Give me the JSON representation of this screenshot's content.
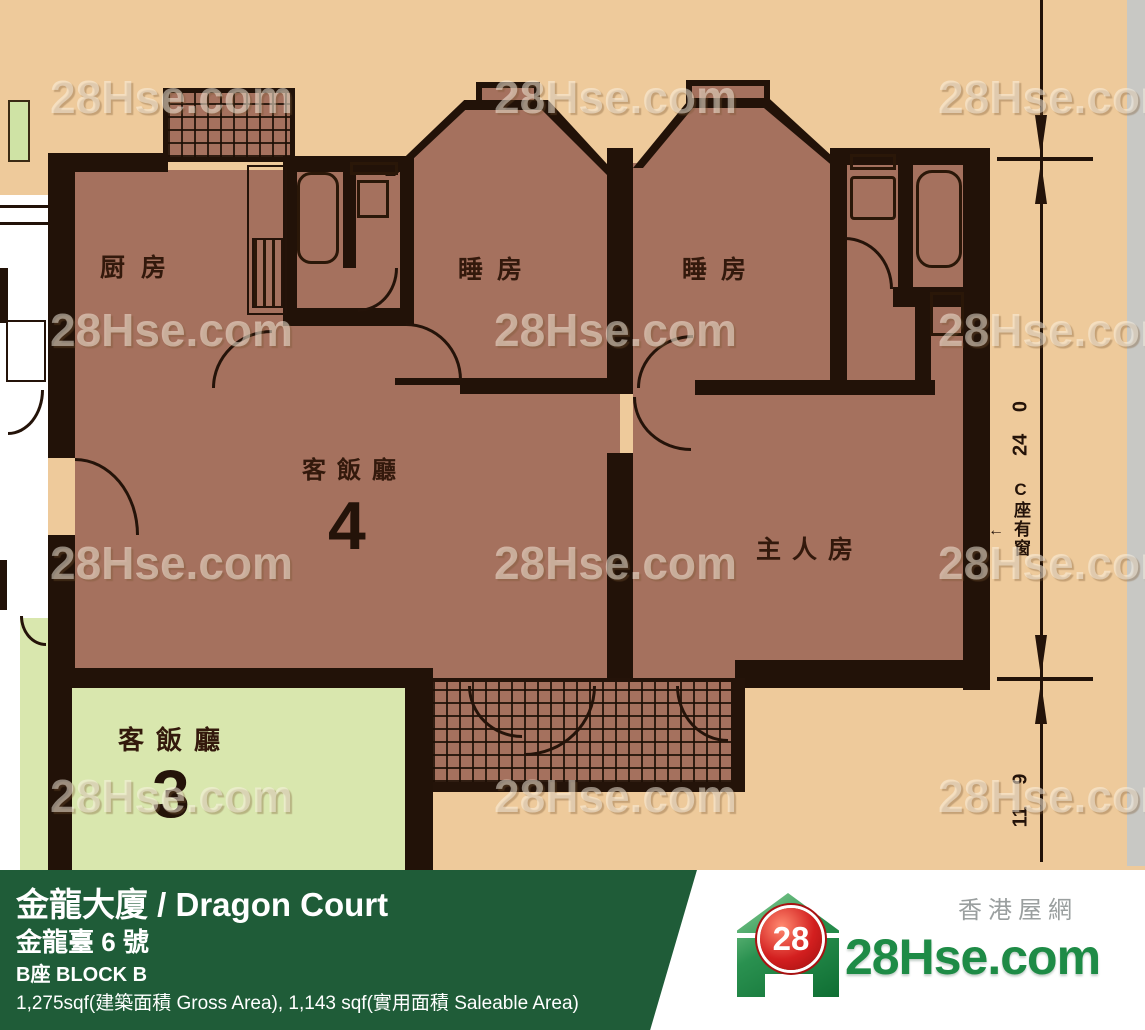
{
  "plan": {
    "watermark": "28Hse.com",
    "rooms": {
      "kitchen": "厨房",
      "bedroom_left": "睡房",
      "bedroom_right": "睡房",
      "living_dining": "客飯廳",
      "living_unit_number": "4",
      "master_bedroom": "主人房",
      "adjacent_living_dining": "客飯廳",
      "adjacent_unit_number": "3"
    },
    "dimensions": {
      "upper_height": "24 0",
      "lower_height": "11 9",
      "window_note": "C座有窗",
      "window_note_arrow": "←"
    }
  },
  "footer": {
    "building_title": "金龍大廈 / Dragon Court",
    "address": "金龍臺 6 號",
    "block": "B座   BLOCK B",
    "areas": "1,275sqf(建築面積 Gross Area), 1,143 sqf(實用面積 Saleable Area)"
  },
  "logo": {
    "badge_number": "28",
    "site_name": "28Hse.com",
    "site_name_chinese": "香港屋網"
  },
  "colors": {
    "background_tan": "#eeca9b",
    "room_fill": "#a5715e",
    "wall": "#221208",
    "adjacent_room_green": "#d9e7ae",
    "footer_green": "#1f5c38",
    "logo_green": "#1e8b46",
    "logo_red": "#cc1b1b",
    "watermark_color": "rgba(252,244,230,0.5)"
  }
}
